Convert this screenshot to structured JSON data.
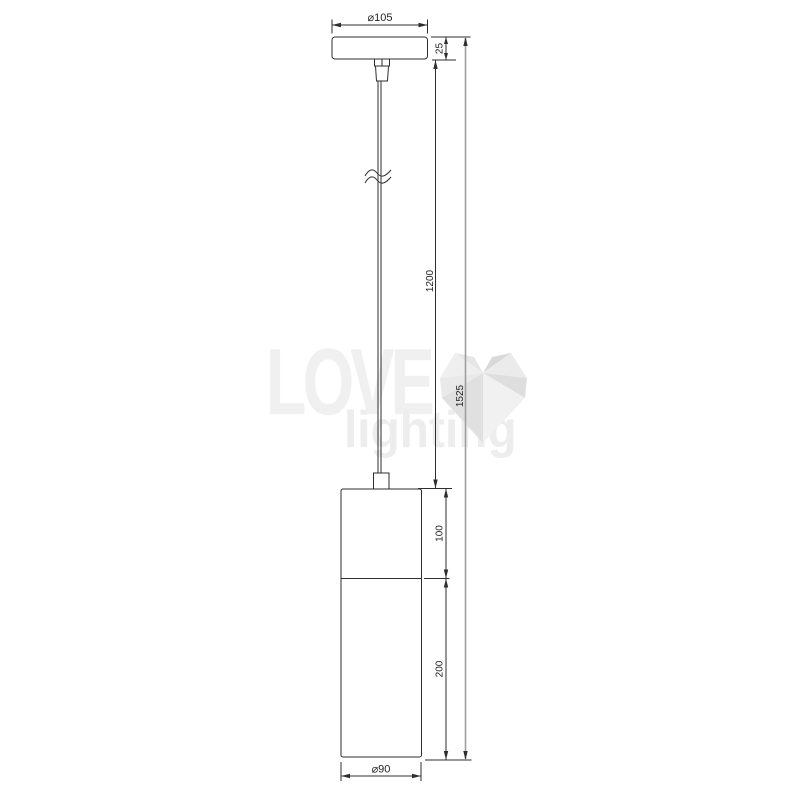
{
  "watermark": {
    "brand_line1": "LOVE",
    "brand_line2": "lighting"
  },
  "dims": {
    "canopy_diameter": "⌀105",
    "canopy_height": "25",
    "cord_length": "1200",
    "overall_height": "1525",
    "body_upper_section": "100",
    "body_lower_section": "200",
    "body_diameter": "⌀90"
  },
  "colors": {
    "line": "#2e2e2e",
    "overall_dim_line": "#9f9f9f",
    "text": "#1f1f1f",
    "watermark_text": "#f0f0f0"
  }
}
